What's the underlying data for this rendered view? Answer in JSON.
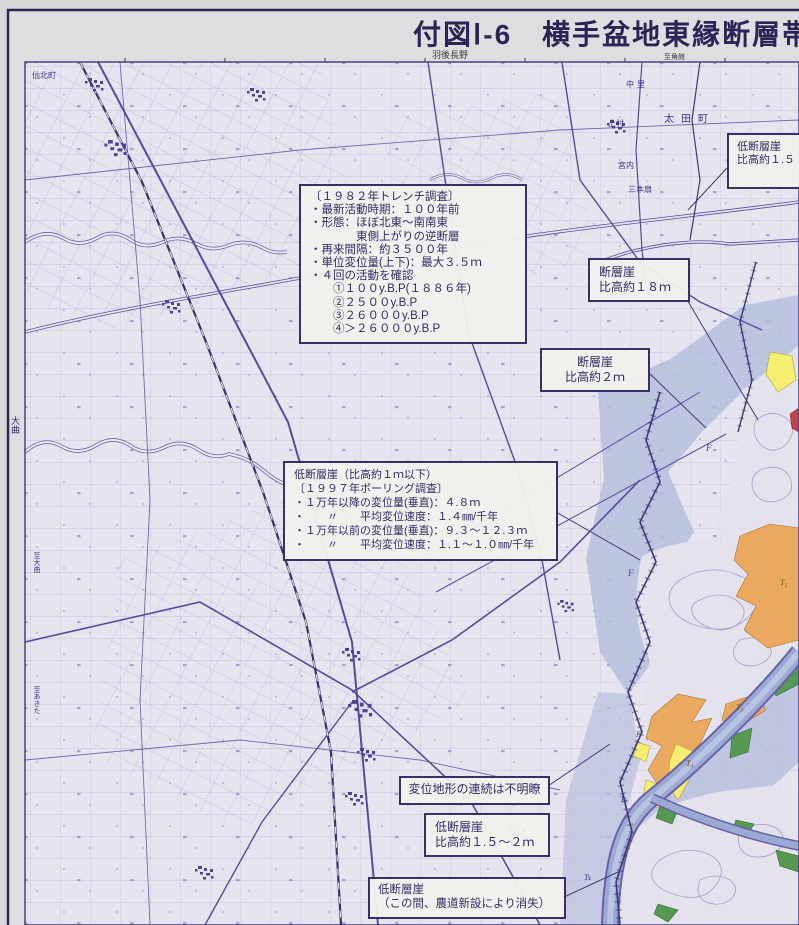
{
  "header": {
    "title": "付図Ⅰ-6　横手盆地東縁断層帯",
    "sheet_label": "羽後長野",
    "corner_label": "至角館"
  },
  "boxes": {
    "low_scarp_ne": {
      "l1": "低断層崖",
      "l2": "比高約１.５"
    },
    "scarp18": {
      "l1": "断層崖",
      "l2": "比高約１８ｍ"
    },
    "scarp2": {
      "l1": "断層崖",
      "l2": "比高約２ｍ"
    },
    "trench1982": {
      "l1": "〔１９８２年トレンチ調査〕",
      "l2": "・最新活動時期：１００年前",
      "l3": "・形態：ほぼ北東～南南東",
      "l4": "　　　　東側上がりの逆断層",
      "l5": "・再来間隔：約３５００年",
      "l6": "・単位変位量(上下)：最大３.５ｍ",
      "l7": "・４回の活動を確認",
      "l8": "　　①１００y.B.P(１８８６年)",
      "l9": "　　②２５００y.B.P",
      "l10": "　　③２６０００y.B.P",
      "l11": "　　④＞２６０００y.B.P"
    },
    "boring1997": {
      "l1": "低断層崖（比高約１ｍ以下）",
      "l2": "〔１９９７年ボーリング調査〕",
      "l3": "・１万年以降の変位量(垂直)：４.８ｍ",
      "l4": "・　　〃　　平均変位速度：１.４㎜/千年",
      "l5": "・１万年以前の変位量(垂直)：９.３～１２.３ｍ",
      "l6": "・　　〃　　平均変位速度：１.１～１.０㎜/千年"
    },
    "unclear": {
      "l1": "変位地形の連続は不明瞭"
    },
    "low_scarp_s": {
      "l1": "低断層崖",
      "l2": "比高約１.５～２ｍ"
    },
    "low_scarp_lost": {
      "l1": "低断層崖",
      "l2": "（この間、農道新設により消失）"
    }
  },
  "map_labels": [
    {
      "t": "太田町"
    },
    {
      "t": "中里"
    },
    {
      "t": "上村"
    },
    {
      "t": "宮内"
    },
    {
      "t": "三本扇"
    },
    {
      "t": "仙北町"
    },
    {
      "t": "大曲"
    },
    {
      "t": "至大曲"
    },
    {
      "t": "至あきた"
    }
  ],
  "geo_labels": [
    "F",
    "F",
    "F",
    "T₂",
    "T₃",
    "T₄",
    "Ts",
    "Ts"
  ],
  "colors": {
    "plain_bg": "#e6e5ef",
    "grid_line": "#958cc2",
    "road_line": "#5a50a0",
    "lowland_blue": "#b3bddc",
    "hill_fill": "#e4e2ec",
    "terrace_orange": "#eaa95e",
    "terrace_yellow": "#f5ee71",
    "terrace_green": "#569751",
    "volcanic_red": "#c4424a",
    "ink_dark": "#373066"
  }
}
